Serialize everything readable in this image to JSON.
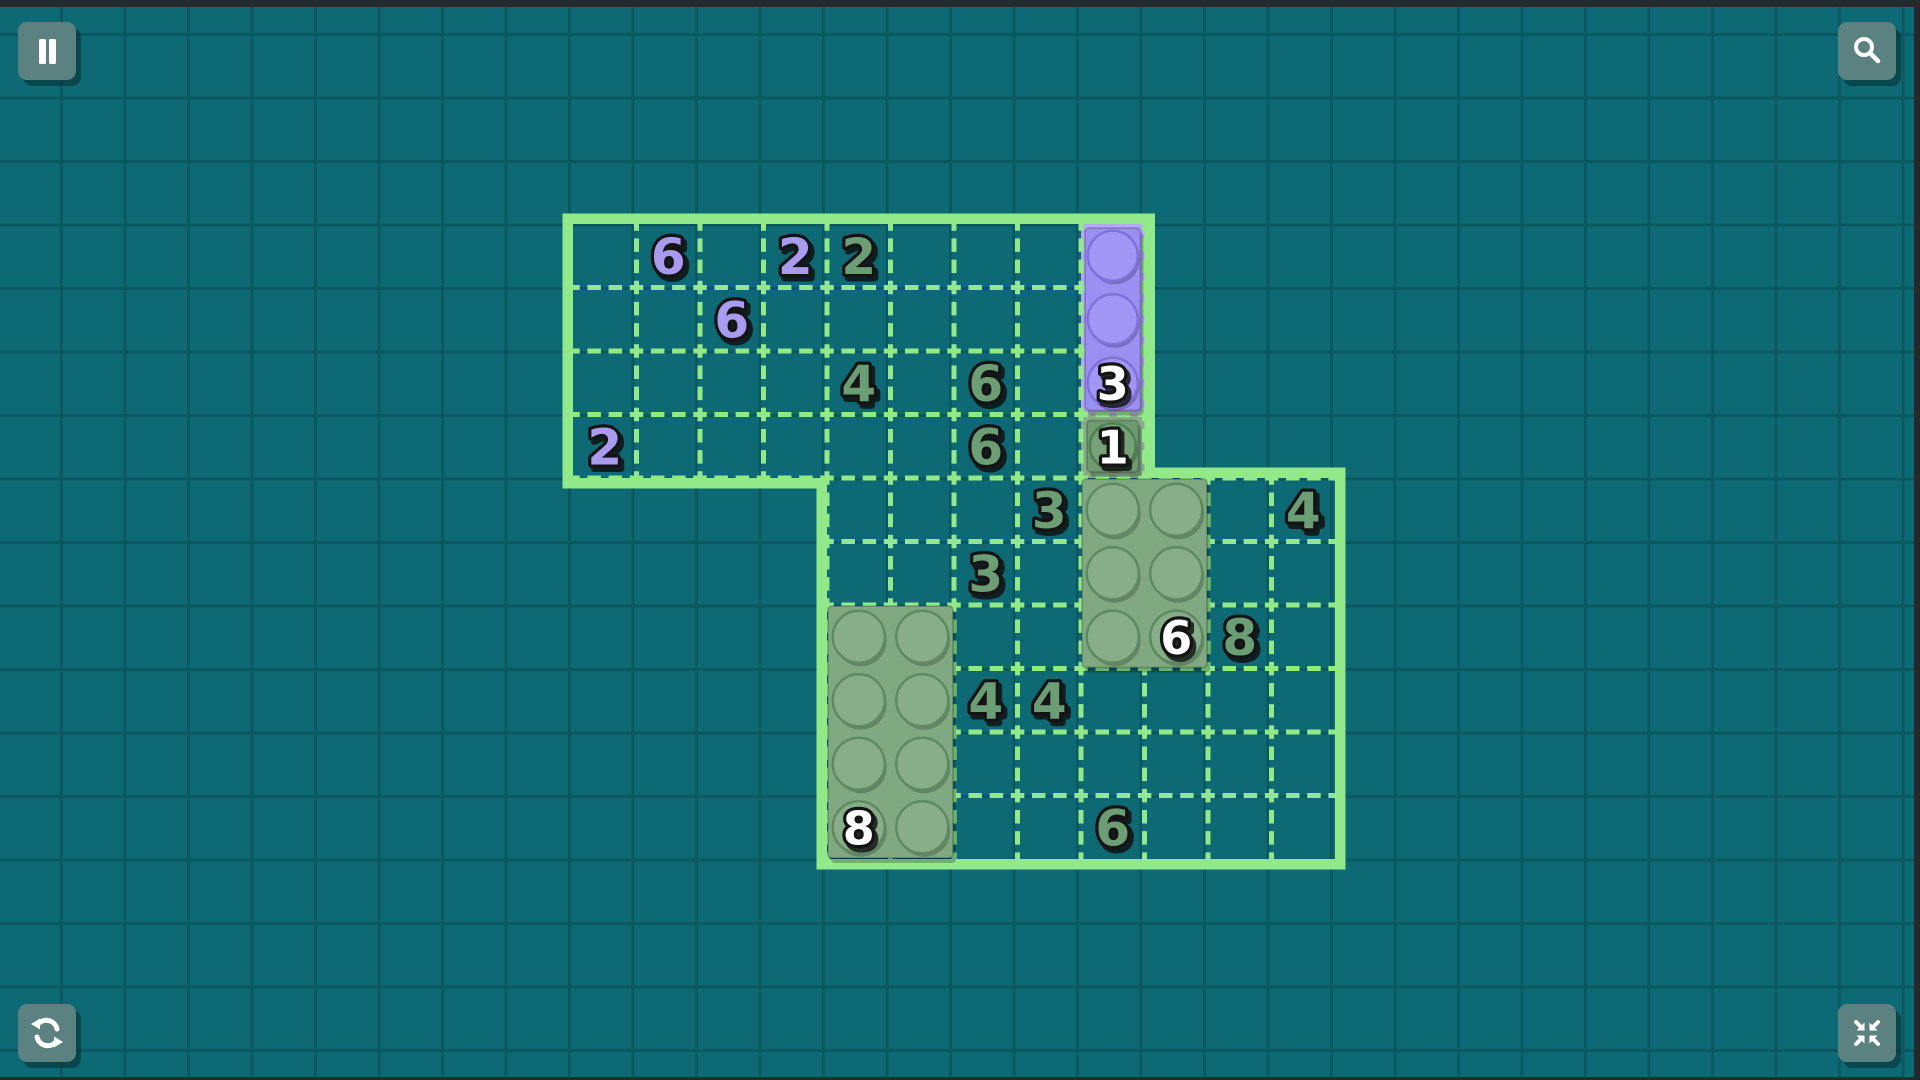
{
  "app": "brick-logic-puzzle",
  "colors": {
    "background": "#0d6a74",
    "background_grid_line": "#0a5862",
    "edge_bar": "#26292b",
    "board_green": "#92e98a",
    "cell_purple_bg": "#b5a8f6",
    "brick_purple": "#9c8ff2",
    "brick_purple_stud": "#a296f4",
    "brick_purple_dark": "#7e72d8",
    "brick_green": "#80a982",
    "brick_green_stud": "#87ae88",
    "brick_green_dark": "#5d8a63",
    "brick_green_small": "#6f9b72",
    "brick_green_small_stud": "#76a179",
    "brick_green_small_dark": "#52804f",
    "cell_green_bg": "#86ac88",
    "clue_purple": "#a89bf0",
    "clue_green": "#6b9e74",
    "stud_label": "#ffffff",
    "text_outline": "#141414",
    "button_bg": "#5c8181",
    "button_icon": "#ffffff"
  },
  "hud": {
    "buttons": [
      {
        "name": "pause-button",
        "icon": "pause-icon",
        "corner": "top-left"
      },
      {
        "name": "zoom-button",
        "icon": "magnifier-icon",
        "corner": "top-right"
      },
      {
        "name": "restart-button",
        "icon": "restart-icon",
        "corner": "bottom-left"
      },
      {
        "name": "exit-fullscreen-button",
        "icon": "compress-icon",
        "corner": "bottom-right"
      }
    ]
  },
  "board": {
    "geometry": {
      "cell": 63.5,
      "origin_x": 573,
      "origin_y": 224,
      "border": 10.5,
      "regions": [
        {
          "name": "upper",
          "col": 0,
          "row": 0,
          "cols": 9,
          "rows": 4
        },
        {
          "name": "lower",
          "col": 4,
          "row": 4,
          "cols": 8,
          "rows": 6
        }
      ]
    },
    "clues": [
      {
        "col": 1,
        "row": 0,
        "value": "6",
        "color": "purple"
      },
      {
        "col": 3,
        "row": 0,
        "value": "2",
        "color": "purple"
      },
      {
        "col": 4,
        "row": 0,
        "value": "2",
        "color": "green"
      },
      {
        "col": 2,
        "row": 1,
        "value": "6",
        "color": "purple"
      },
      {
        "col": 4,
        "row": 2,
        "value": "4",
        "color": "green"
      },
      {
        "col": 6,
        "row": 2,
        "value": "6",
        "color": "green"
      },
      {
        "col": 0,
        "row": 3,
        "value": "2",
        "color": "purple"
      },
      {
        "col": 6,
        "row": 3,
        "value": "6",
        "color": "green"
      },
      {
        "col": 7,
        "row": 4,
        "value": "3",
        "color": "green"
      },
      {
        "col": 11,
        "row": 4,
        "value": "4",
        "color": "green"
      },
      {
        "col": 6,
        "row": 5,
        "value": "3",
        "color": "green"
      },
      {
        "col": 10,
        "row": 6,
        "value": "8",
        "color": "green"
      },
      {
        "col": 6,
        "row": 7,
        "value": "4",
        "color": "green"
      },
      {
        "col": 7,
        "row": 7,
        "value": "4",
        "color": "green"
      },
      {
        "col": 8,
        "row": 9,
        "value": "6",
        "color": "green"
      }
    ],
    "pieces": [
      {
        "name": "purple-brick-1x3",
        "color": "purple",
        "col": 8,
        "row": 0,
        "w": 1,
        "h": 3,
        "label": "3",
        "label_col": 0,
        "label_row": 2,
        "cell_bg": true
      },
      {
        "name": "green-brick-1x1",
        "color": "green_small",
        "col": 8,
        "row": 3,
        "w": 1,
        "h": 1,
        "label": "1",
        "label_col": 0,
        "label_row": 0,
        "cell_bg": true
      },
      {
        "name": "green-brick-2x3",
        "color": "green",
        "col": 8,
        "row": 4,
        "w": 2,
        "h": 3,
        "label": "6",
        "label_col": 1,
        "label_row": 2,
        "cell_bg": false
      },
      {
        "name": "green-brick-2x4",
        "color": "green",
        "col": 4,
        "row": 6,
        "w": 2,
        "h": 4,
        "label": "8",
        "label_col": 0,
        "label_row": 3,
        "cell_bg": false
      }
    ]
  }
}
